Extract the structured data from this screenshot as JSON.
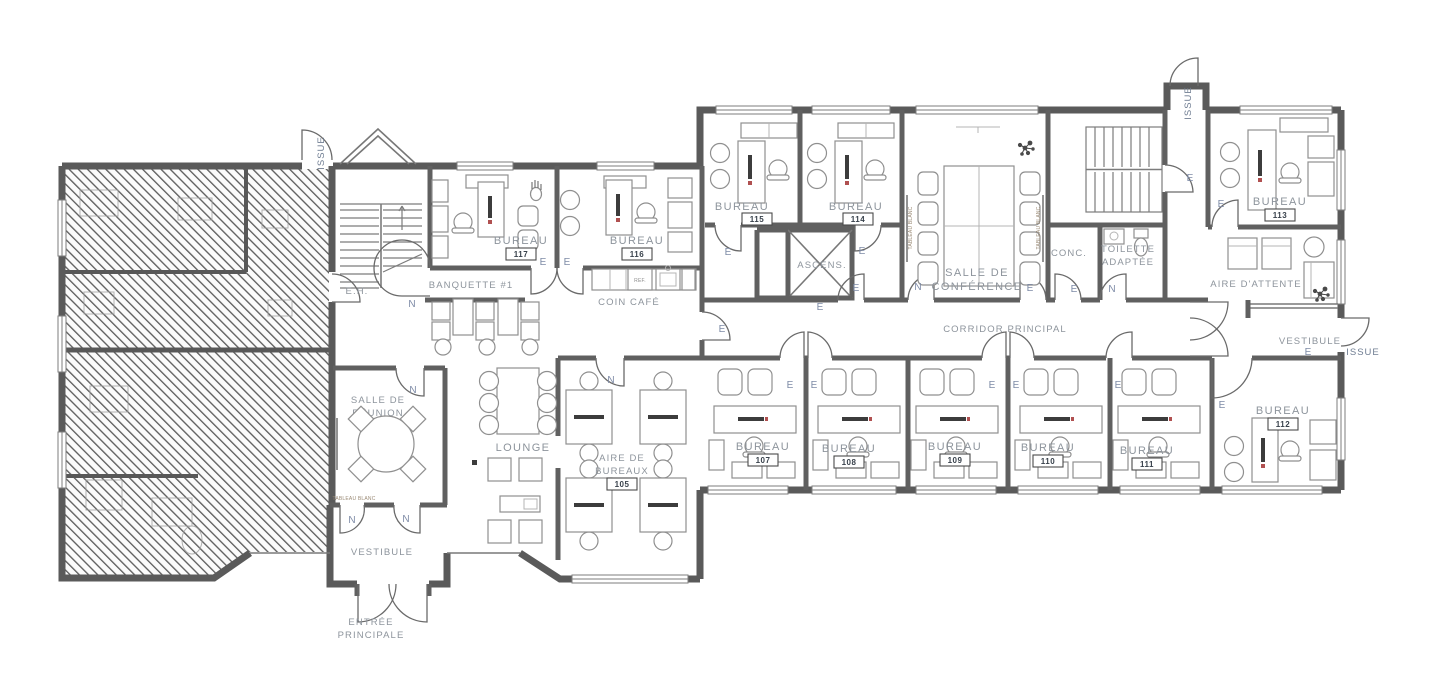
{
  "labels": {
    "bureau": "BUREAU",
    "issue": "ISSUE",
    "eh": "E.H.",
    "banquette": "BANQUETTE #1",
    "coin_cafe": "COIN CAFÉ",
    "ref": "REF.",
    "ascenseur": "ASCENS.",
    "conference_l1": "SALLE DE",
    "conference_l2": "CONFÉRENCE",
    "conc": "CONC.",
    "toilette_l1": "TOILETTE",
    "toilette_l2": "ADAPTÉE",
    "attente": "AIRE D'ATTENTE",
    "corridor": "CORRIDOR PRINCIPAL",
    "vestibule": "VESTIBULE",
    "reunion_l1": "SALLE DE",
    "reunion_l2": "RÉUNION",
    "lounge": "LOUNGE",
    "aire_l1": "AIRE DE",
    "aire_l2": "BUREAUX",
    "entree_l1": "ENTRÉE",
    "entree_l2": "PRINCIPALE",
    "tableau_blanc": "TABLEAU BLANC",
    "door_e": "E",
    "door_n": "N"
  },
  "rooms": {
    "open_area_num": "105",
    "offices": [
      {
        "num": "117"
      },
      {
        "num": "116"
      },
      {
        "num": "115"
      },
      {
        "num": "114"
      },
      {
        "num": "113"
      },
      {
        "num": "107"
      },
      {
        "num": "108"
      },
      {
        "num": "109"
      },
      {
        "num": "110"
      },
      {
        "num": "111"
      },
      {
        "num": "112"
      }
    ]
  },
  "colors": {
    "wall": "#5a5a5a",
    "room_label": "#8d949c",
    "door_label": "#7d8aa6",
    "furniture": "#8f8f8f"
  }
}
